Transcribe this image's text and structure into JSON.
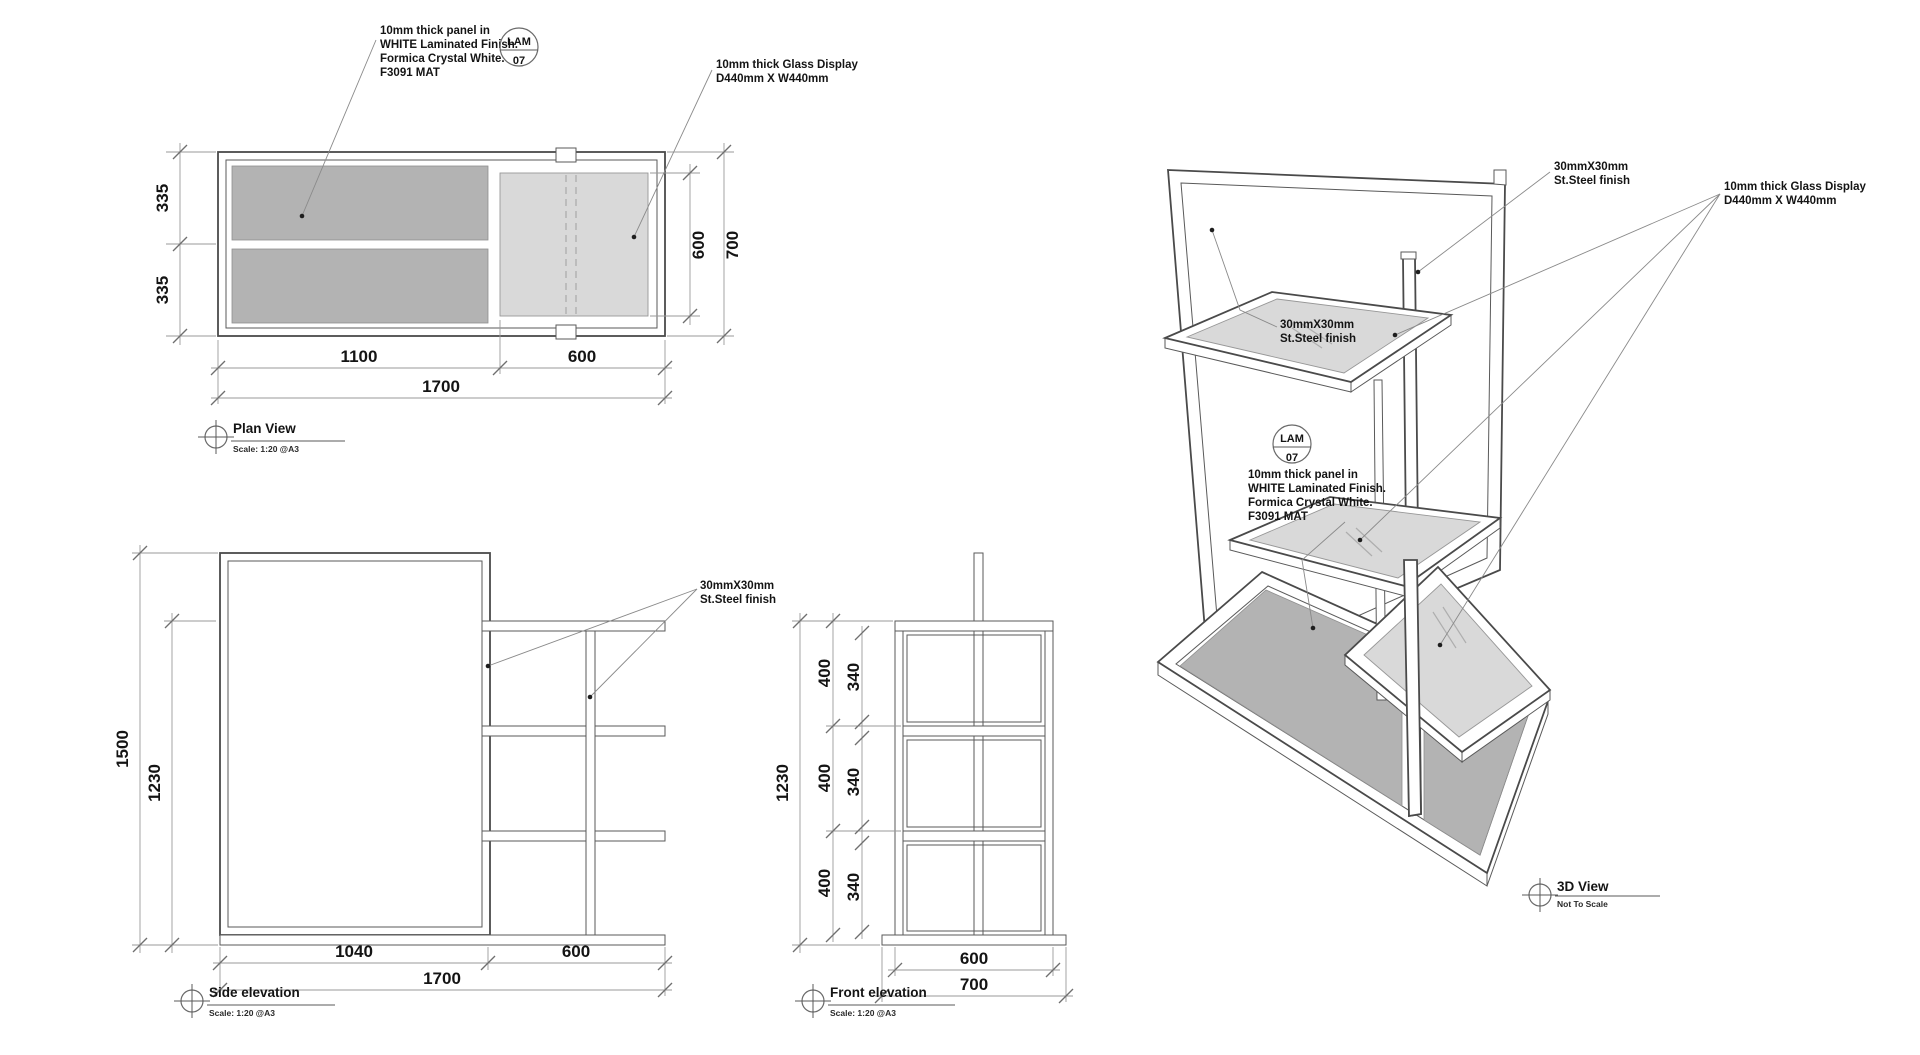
{
  "sheet": {
    "type": "furniture shop drawing",
    "unit": "display stand"
  },
  "views": {
    "plan": {
      "title": "Plan View",
      "scale": "Scale: 1:20 @A3",
      "dims": {
        "left": [
          "335",
          "335"
        ],
        "right_glass": "600",
        "right_overall": "700",
        "bottom": [
          "1100",
          "600"
        ],
        "overall": "1700"
      }
    },
    "side": {
      "title": "Side elevation",
      "scale": "Scale: 1:20 @A3",
      "dims": {
        "height": "1500",
        "shelf_height": "1230",
        "bottom": [
          "1040",
          "600"
        ],
        "overall": "1700"
      }
    },
    "front": {
      "title": "Front elevation",
      "scale": "Scale: 1:20 @A3",
      "dims": {
        "height": "1230",
        "sections": [
          "400",
          "400",
          "400"
        ],
        "openings": [
          "340",
          "340",
          "340"
        ],
        "width": "600",
        "base_width": "700"
      }
    },
    "three_d": {
      "title": "3D View",
      "scale": "Not To Scale"
    }
  },
  "annotations": {
    "lam_tag": {
      "line1": "LAM",
      "line2": "07"
    },
    "panel_note": {
      "line1": "10mm thick panel in",
      "line2": "WHITE Laminated Finish.",
      "line3": "Formica Crystal White.",
      "line4": "F3091 MAT"
    },
    "glass_note": {
      "line1": "10mm thick Glass Display",
      "line2": "D440mm X W440mm"
    },
    "steel_note": {
      "line1": "30mmX30mm",
      "line2": "St.Steel finish"
    }
  },
  "colors": {
    "background": "#ffffff",
    "object_line": "#4a4a4a",
    "dimension_line": "#9a9a9a",
    "laminate_panel_fill": "#b3b3b3",
    "glass_fill": "#d9d9d9",
    "text": "#141414"
  }
}
